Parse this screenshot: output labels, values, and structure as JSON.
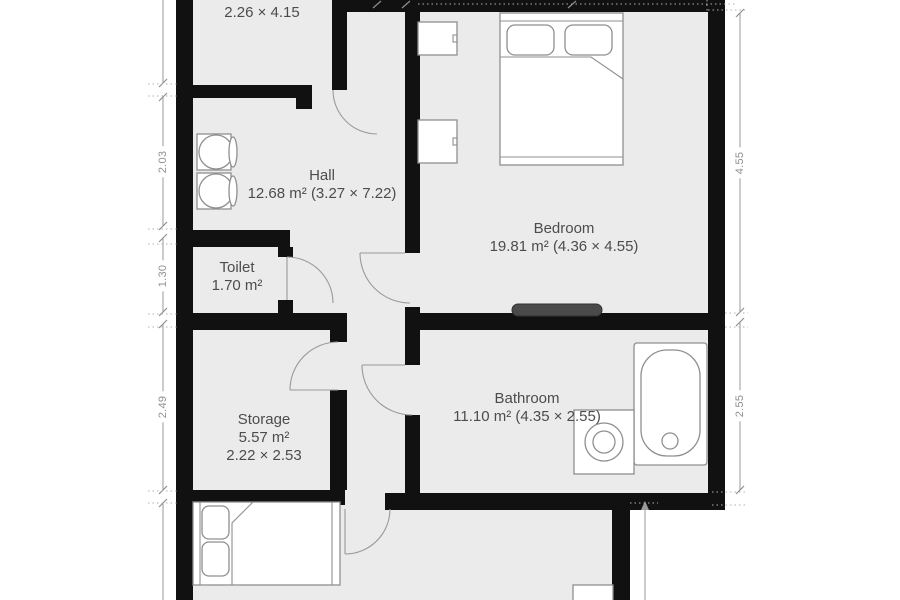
{
  "title": "apartment-floor-plan",
  "rooms": {
    "top_room": {
      "area": "9.38 m²",
      "dims": "2.26 × 4.15"
    },
    "hall": {
      "name": "Hall",
      "details": "12.68 m² (3.27 × 7.22)"
    },
    "toilet": {
      "name": "Toilet",
      "area": "1.70 m²"
    },
    "storage": {
      "name": "Storage",
      "area": "5.57 m²",
      "dims": "2.22 × 2.53"
    },
    "bedroom": {
      "name": "Bedroom",
      "details": "19.81 m² (4.36 × 4.55)"
    },
    "bathroom": {
      "name": "Bathroom",
      "details": "11.10 m² (4.35 × 2.55)"
    }
  },
  "dimensions": {
    "left": {
      "a": "2.03",
      "b": "1.30",
      "c": "2.49"
    },
    "right": {
      "a": "4.55",
      "b": "2.55"
    }
  },
  "furniture": [
    "double-bed",
    "bedside-cabinet",
    "bedside-cabinet",
    "radiator",
    "bathtub",
    "washing-machine",
    "hall-sink",
    "hall-sink",
    "double-bed-bottom",
    "cabinet-fragment"
  ],
  "colors": {
    "wall": "#111111",
    "floor": "#ebebeb",
    "furniture_outline": "#8f8f8f",
    "dimension_line": "#9a9a9a",
    "room_label": "#4c4c4c",
    "radiator": "#4a4a4a"
  }
}
